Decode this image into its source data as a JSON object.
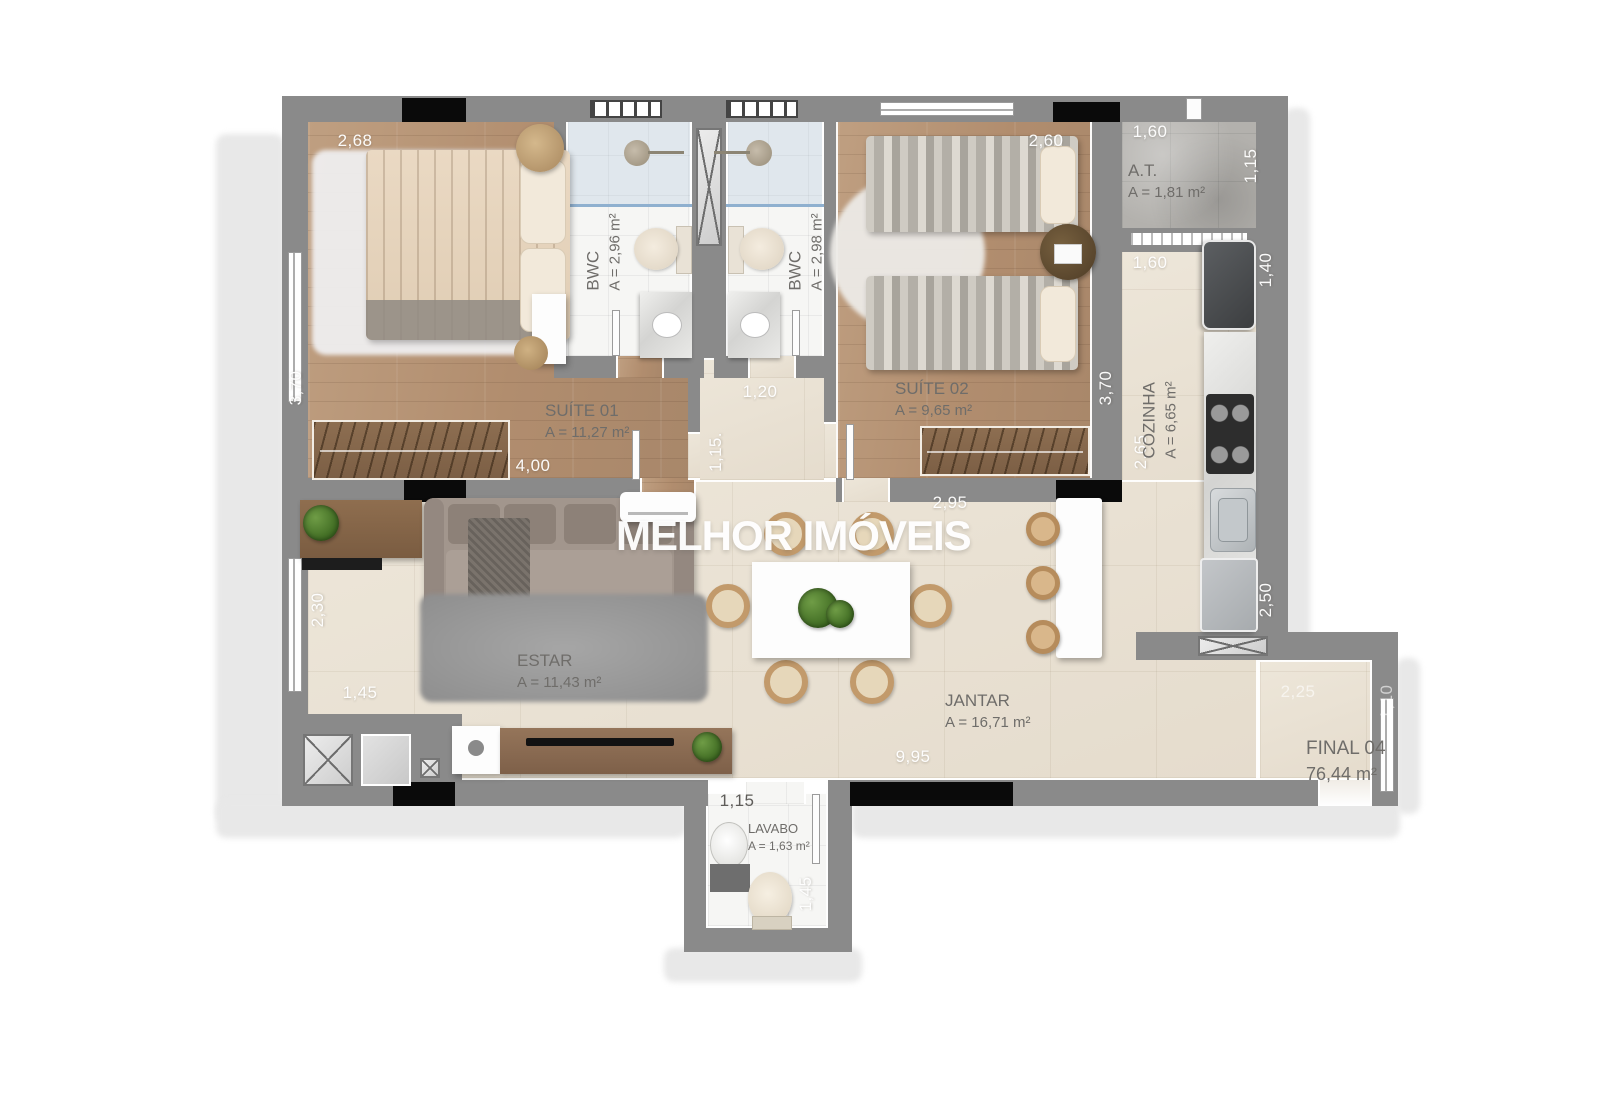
{
  "watermark": {
    "text": "MELHOR IMÓVEIS"
  },
  "rooms": {
    "suite01": {
      "name": "SUÍTE 01",
      "area": "A = 11,27  m²"
    },
    "bwc01": {
      "name": "BWC",
      "area": "A = 2,96 m²"
    },
    "bwc02": {
      "name": "BWC",
      "area": "A = 2,98 m²"
    },
    "suite02": {
      "name": "SUÍTE 02",
      "area": "A = 9,65  m²"
    },
    "areaTecnica": {
      "name": "A.T.",
      "area": "A = 1,81  m²"
    },
    "cozinha": {
      "name": "COZINHA",
      "area": "A = 6,65 m²"
    },
    "estar": {
      "name": "ESTAR",
      "area": "A = 11,43 m²"
    },
    "jantar": {
      "name": "JANTAR",
      "area": "A = 16,71 m²"
    },
    "lavabo": {
      "name": "LAVABO",
      "area": "A = 1,63 m²"
    },
    "unit": {
      "name": "FINAL 04",
      "area": "76,44 m²"
    }
  },
  "dimensions": {
    "suite01_top": "2,68",
    "suite01_left": "3,70",
    "suite01_bottom": "4,00",
    "suite02_top": "2,60",
    "suite02_right": "3,70",
    "suite02_bottom": "2,95",
    "at_top": "1,60",
    "at_right": "1,15",
    "cozinha_top": "1,60",
    "cozinha_right_upper": "1,40",
    "cozinha_left": "2,65",
    "cozinha_right_lower": "2,50",
    "hall_top": "1,20",
    "hall_left": "1,15.",
    "estar_left": "2,30",
    "estar_bottom": "1,45",
    "jantar_bottom": "9,95",
    "lavabo_top": "1,15",
    "lavabo_right": "1,45",
    "terrace_top": "2,25",
    "terrace_right": "1,10"
  },
  "colors": {
    "wall": "#8a8a8a",
    "column": "#0a0a0a",
    "wood_floor": "#b18d6e",
    "social_floor": "#e9e2d5",
    "bath_floor": "#f6f6f4",
    "concrete": "#b3b1ad",
    "glass": "#8fb0cf",
    "watermark": "#ffffff"
  }
}
